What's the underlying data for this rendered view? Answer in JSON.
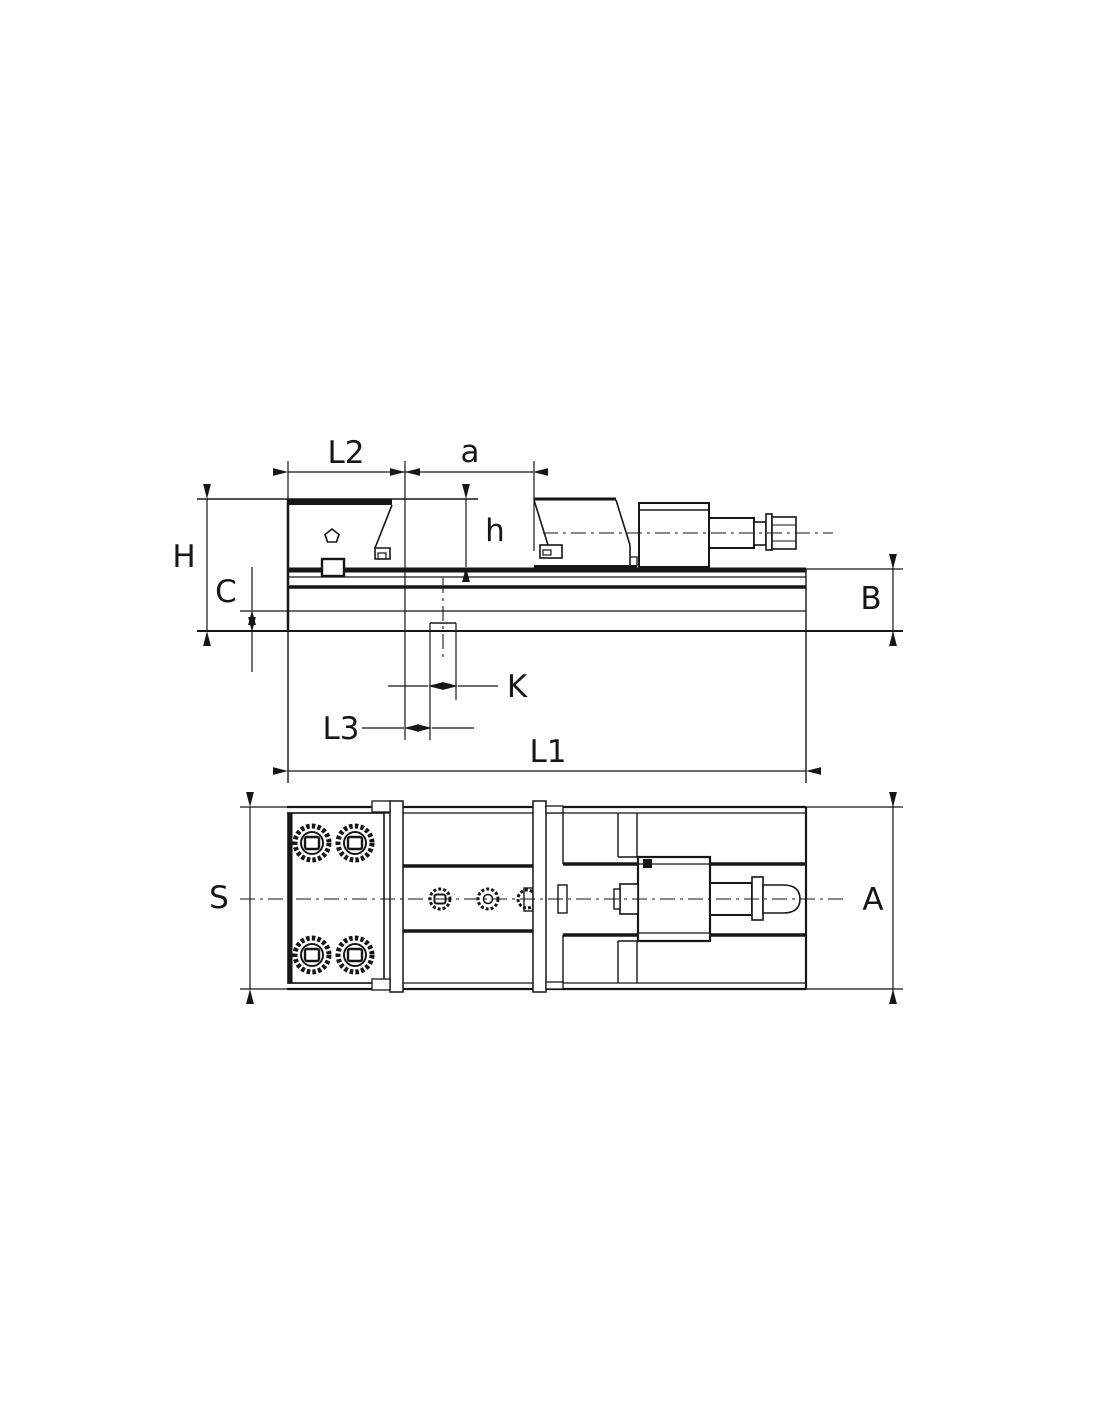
{
  "page": {
    "background": "#ffffff"
  },
  "drawing": {
    "line_color": "#161616",
    "style": "black line technical drawing, two orthographic views of a machine vise"
  },
  "labels": {
    "L2": "L2",
    "a": "a",
    "h": "h",
    "H": "H",
    "C": "C",
    "B": "B",
    "K": "K",
    "L3": "L3",
    "L1": "L1",
    "S": "S",
    "A": "A"
  }
}
